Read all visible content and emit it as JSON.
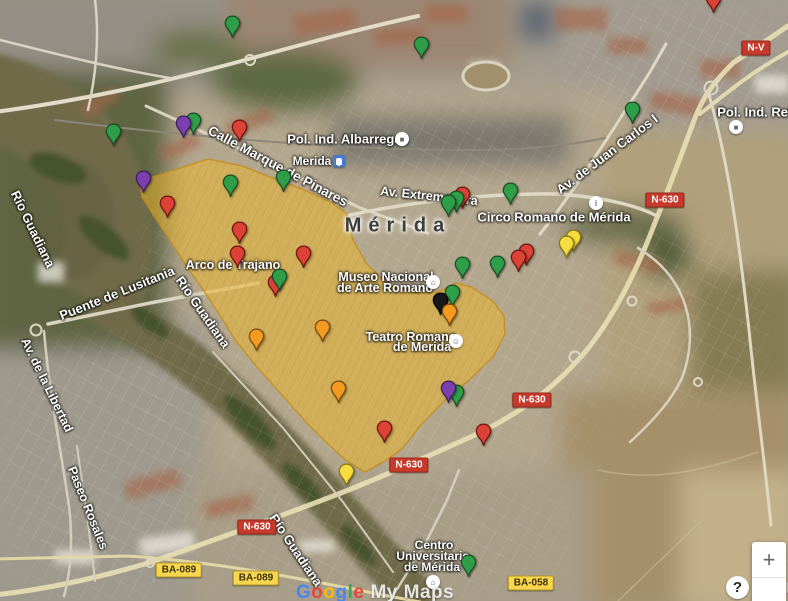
{
  "city": {
    "label": "Mérida"
  },
  "street_labels": [
    {
      "id": "calle-marques-de-pinares",
      "text": "Calle Marque de Pinares",
      "x": 278,
      "y": 166,
      "rot": 28,
      "size": 13.5
    },
    {
      "id": "pol-ind-albarregas",
      "text": "Pol. Ind. Albarregas",
      "x": 348,
      "y": 139,
      "rot": 0,
      "size": 13
    },
    {
      "id": "merida-station",
      "text": "Merida",
      "x": 312,
      "y": 161,
      "rot": 0,
      "size": 12
    },
    {
      "id": "av-extremadura",
      "text": "Av. Extremadura",
      "x": 429,
      "y": 196,
      "rot": 6,
      "size": 12.5
    },
    {
      "id": "circo-romano-de-merida",
      "text": "Circo Romano de Mérida",
      "x": 554,
      "y": 217,
      "rot": 0,
      "size": 13
    },
    {
      "id": "av-de-juan-carlos-i",
      "text": "Av. de Juan Carlos I",
      "x": 607,
      "y": 154,
      "rot": -37,
      "size": 13
    },
    {
      "id": "pol-ind-reina",
      "text": "Pol. Ind. Reina",
      "x": 762,
      "y": 112,
      "rot": 0,
      "size": 13
    },
    {
      "id": "merida-city",
      "text": "Mérida",
      "x": 398,
      "y": 226,
      "rot": 0,
      "size": 20,
      "kind": "city"
    },
    {
      "id": "museo-nacional-line1",
      "text": "Museo Nacional",
      "x": 386,
      "y": 277,
      "rot": 0,
      "size": 12.5
    },
    {
      "id": "museo-nacional-line2",
      "text": "de Arte Romano",
      "x": 385,
      "y": 288,
      "rot": 0,
      "size": 12.5
    },
    {
      "id": "teatro-romano-line1",
      "text": "Teatro Romano",
      "x": 411,
      "y": 337,
      "rot": 0,
      "size": 12.5
    },
    {
      "id": "teatro-romano-line2",
      "text": "de Merida",
      "x": 422,
      "y": 347,
      "rot": 0,
      "size": 12.5
    },
    {
      "id": "arco-de-trajano",
      "text": "Arco de Trajano",
      "x": 233,
      "y": 265,
      "rot": 0,
      "size": 12.5
    },
    {
      "id": "rio-guadiana-west",
      "text": "Río Guadiana",
      "x": 33,
      "y": 229,
      "rot": 64,
      "size": 13
    },
    {
      "id": "rio-guadiana-mid",
      "text": "Río Guadiana",
      "x": 203,
      "y": 312,
      "rot": 55,
      "size": 13
    },
    {
      "id": "rio-guadiana-south",
      "text": "Río Guadiana",
      "x": 296,
      "y": 550,
      "rot": 56,
      "size": 13
    },
    {
      "id": "puente-de-lusitania",
      "text": "Puente de Lusitania",
      "x": 117,
      "y": 293,
      "rot": -22,
      "size": 13
    },
    {
      "id": "av-de-la-libertad",
      "text": "Av. de la Libertad",
      "x": 47,
      "y": 385,
      "rot": 64,
      "size": 12.5
    },
    {
      "id": "paseo-rosales",
      "text": "Paseo Rosales",
      "x": 88,
      "y": 508,
      "rot": 68,
      "size": 12.5
    },
    {
      "id": "centro-universitario-line1",
      "text": "Centro",
      "x": 434,
      "y": 545,
      "rot": 0,
      "size": 12
    },
    {
      "id": "centro-universitario-line2",
      "text": "Universitario",
      "x": 433,
      "y": 556,
      "rot": 0,
      "size": 12
    },
    {
      "id": "centro-universitario-line3",
      "text": "de Mérida",
      "x": 432,
      "y": 567,
      "rot": 0,
      "size": 12
    }
  ],
  "road_badges": [
    {
      "text": "N-V",
      "x": 756,
      "y": 48,
      "style": "red"
    },
    {
      "text": "N-630",
      "x": 665,
      "y": 200,
      "style": "red"
    },
    {
      "text": "N-630",
      "x": 532,
      "y": 400,
      "style": "red"
    },
    {
      "text": "N-630",
      "x": 409,
      "y": 465,
      "style": "red"
    },
    {
      "text": "N-630",
      "x": 257,
      "y": 527,
      "style": "red"
    },
    {
      "text": "BA-089",
      "x": 179,
      "y": 570,
      "style": "yellow"
    },
    {
      "text": "BA-089",
      "x": 256,
      "y": 578,
      "style": "yellow"
    },
    {
      "text": "BA-058",
      "x": 531,
      "y": 583,
      "style": "yellow"
    }
  ],
  "poi_icons": [
    {
      "id": "pol-ind-albarregas-poi",
      "x": 402,
      "y": 139,
      "glyph": "■",
      "type": "circle"
    },
    {
      "id": "merida-station-transit",
      "x": 339,
      "y": 161,
      "glyph": "",
      "type": "transit"
    },
    {
      "id": "circo-romano-poi",
      "x": 596,
      "y": 203,
      "glyph": "i",
      "type": "circle"
    },
    {
      "id": "pol-ind-reina-poi",
      "x": 736,
      "y": 127,
      "glyph": "■",
      "type": "circle"
    },
    {
      "id": "museo-arte-romano-poi",
      "x": 433,
      "y": 282,
      "glyph": "⌂",
      "type": "circle"
    },
    {
      "id": "teatro-romano-poi",
      "x": 456,
      "y": 341,
      "glyph": "☺",
      "type": "circle"
    },
    {
      "id": "centro-universitario-poi",
      "x": 433,
      "y": 582,
      "glyph": "⌂",
      "type": "circle"
    }
  ],
  "highlight_polygon": {
    "fill": "rgba(236,182,44,0.52)",
    "stroke": "rgba(196,140,22,0.8)",
    "points": [
      [
        140,
        181
      ],
      [
        208,
        159
      ],
      [
        242,
        166
      ],
      [
        270,
        177
      ],
      [
        302,
        189
      ],
      [
        332,
        203
      ],
      [
        346,
        213
      ],
      [
        353,
        240
      ],
      [
        366,
        263
      ],
      [
        389,
        286
      ],
      [
        416,
        293
      ],
      [
        438,
        292
      ],
      [
        456,
        283
      ],
      [
        471,
        287
      ],
      [
        493,
        301
      ],
      [
        504,
        316
      ],
      [
        505,
        334
      ],
      [
        493,
        357
      ],
      [
        469,
        380
      ],
      [
        444,
        401
      ],
      [
        419,
        427
      ],
      [
        403,
        448
      ],
      [
        385,
        461
      ],
      [
        365,
        472
      ],
      [
        347,
        461
      ],
      [
        329,
        445
      ],
      [
        307,
        423
      ],
      [
        282,
        395
      ],
      [
        257,
        367
      ],
      [
        236,
        341
      ],
      [
        221,
        317
      ],
      [
        204,
        291
      ],
      [
        187,
        267
      ],
      [
        169,
        239
      ],
      [
        154,
        216
      ],
      [
        142,
        197
      ]
    ]
  },
  "pin_palette": {
    "green": {
      "fill": "#2f9e48",
      "stroke": "#1d4d26"
    },
    "red": {
      "fill": "#dd4236",
      "stroke": "#6e1611"
    },
    "purple": {
      "fill": "#7c3fae",
      "stroke": "#3f1f5c"
    },
    "orange": {
      "fill": "#f39a20",
      "stroke": "#7c4a0c"
    },
    "yellow": {
      "fill": "#f6dc3c",
      "stroke": "#8a7a18"
    },
    "black": {
      "fill": "#181818",
      "stroke": "#000000"
    }
  },
  "pins": [
    {
      "color": "green",
      "x": 193,
      "y": 135
    },
    {
      "color": "purple",
      "x": 183,
      "y": 138
    },
    {
      "color": "green",
      "x": 113,
      "y": 146
    },
    {
      "color": "green",
      "x": 232,
      "y": 38
    },
    {
      "color": "red",
      "x": 239,
      "y": 142
    },
    {
      "color": "purple",
      "x": 143,
      "y": 193
    },
    {
      "color": "red",
      "x": 167,
      "y": 218
    },
    {
      "color": "green",
      "x": 230,
      "y": 197
    },
    {
      "color": "green",
      "x": 283,
      "y": 192
    },
    {
      "color": "red",
      "x": 239,
      "y": 244
    },
    {
      "color": "red",
      "x": 237,
      "y": 268
    },
    {
      "color": "red",
      "x": 303,
      "y": 268
    },
    {
      "color": "red",
      "x": 275,
      "y": 297
    },
    {
      "color": "green",
      "x": 279,
      "y": 291
    },
    {
      "color": "green",
      "x": 421,
      "y": 59
    },
    {
      "color": "red",
      "x": 713,
      "y": 13
    },
    {
      "color": "green",
      "x": 632,
      "y": 124
    },
    {
      "color": "green",
      "x": 510,
      "y": 205
    },
    {
      "color": "red",
      "x": 462,
      "y": 209
    },
    {
      "color": "green",
      "x": 456,
      "y": 213
    },
    {
      "color": "green",
      "x": 448,
      "y": 217
    },
    {
      "color": "yellow",
      "x": 573,
      "y": 252
    },
    {
      "color": "yellow",
      "x": 566,
      "y": 258
    },
    {
      "color": "red",
      "x": 526,
      "y": 266
    },
    {
      "color": "red",
      "x": 518,
      "y": 272
    },
    {
      "color": "green",
      "x": 497,
      "y": 278
    },
    {
      "color": "green",
      "x": 462,
      "y": 279
    },
    {
      "color": "green",
      "x": 452,
      "y": 307
    },
    {
      "color": "black",
      "x": 440,
      "y": 315
    },
    {
      "color": "orange",
      "x": 449,
      "y": 326
    },
    {
      "color": "orange",
      "x": 322,
      "y": 342
    },
    {
      "color": "orange",
      "x": 256,
      "y": 351
    },
    {
      "color": "orange",
      "x": 338,
      "y": 403
    },
    {
      "color": "green",
      "x": 456,
      "y": 407
    },
    {
      "color": "purple",
      "x": 448,
      "y": 403
    },
    {
      "color": "red",
      "x": 384,
      "y": 443
    },
    {
      "color": "red",
      "x": 483,
      "y": 446
    },
    {
      "color": "yellow",
      "x": 346,
      "y": 486
    },
    {
      "color": "green",
      "x": 468,
      "y": 577
    }
  ],
  "watermark": {
    "brand_letters": [
      {
        "ch": "G",
        "color": "#4285f4"
      },
      {
        "ch": "o",
        "color": "#ea4335"
      },
      {
        "ch": "o",
        "color": "#fbbc05"
      },
      {
        "ch": "g",
        "color": "#4285f4"
      },
      {
        "ch": "l",
        "color": "#34a853"
      },
      {
        "ch": "e",
        "color": "#ea4335"
      }
    ],
    "suffix": "My Maps"
  },
  "corner": {
    "help_glyph": "?",
    "text": "com"
  },
  "controls": {
    "zoom_in": "+"
  }
}
